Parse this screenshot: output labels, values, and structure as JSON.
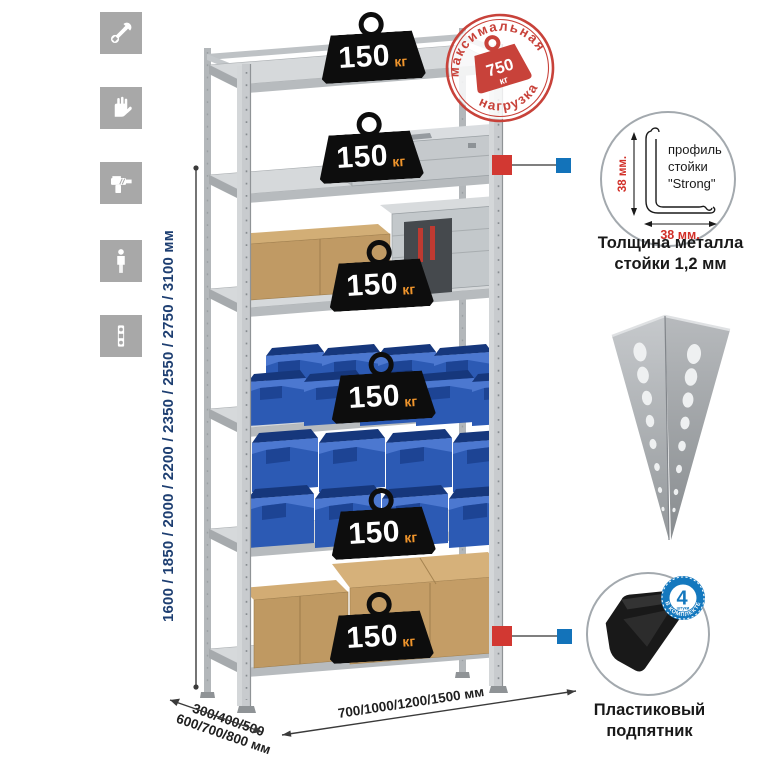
{
  "accent_colors": {
    "stamp_red": "#c8423a",
    "badge_black": "#0d0d0d",
    "badge_unit_orange": "#f0952c",
    "bin_blue": "#2c5ab4",
    "dimension_text_navy": "#1d3e71",
    "info_badge_blue": "#1478be",
    "connector_red": "#d23832",
    "connector_blue": "#1373ba"
  },
  "feature_icons": [
    {
      "name": "wrench"
    },
    {
      "name": "gloves"
    },
    {
      "name": "drill"
    },
    {
      "name": "person"
    },
    {
      "name": "level"
    }
  ],
  "dimensions": {
    "height_label": "1600 / 1850 / 2000 / 2200 / 2350 / 2550 / 2750 / 3100 мм",
    "depth_label_line1": "300/400/500",
    "depth_label_line2": "600/700/800 мм",
    "width_label": "700/1000/1200/1500 мм"
  },
  "shelf_badges": [
    {
      "value": "150",
      "unit": "кг"
    },
    {
      "value": "150",
      "unit": "кг"
    },
    {
      "value": "150",
      "unit": "кг"
    },
    {
      "value": "150",
      "unit": "кг"
    },
    {
      "value": "150",
      "unit": "кг"
    },
    {
      "value": "150",
      "unit": "кг"
    }
  ],
  "max_load_stamp": {
    "arc_top": "максимальная",
    "arc_bottom": "нагрузка",
    "value": "750",
    "unit": "кг"
  },
  "profile_detail": {
    "label_line1": "профиль",
    "label_line2": "стойки",
    "label_line3": "\"Strong\"",
    "vertical_dim": "38 мм.",
    "horizontal_dim": "38 мм.",
    "caption_line1": "Толщина металла",
    "caption_line2": "стойки 1,2 мм"
  },
  "foot_detail": {
    "badge_number": "4",
    "badge_small_text": "штуки",
    "badge_arc_text": "в комплекте",
    "caption_line1": "Пластиковый",
    "caption_line2": "подпятник"
  }
}
